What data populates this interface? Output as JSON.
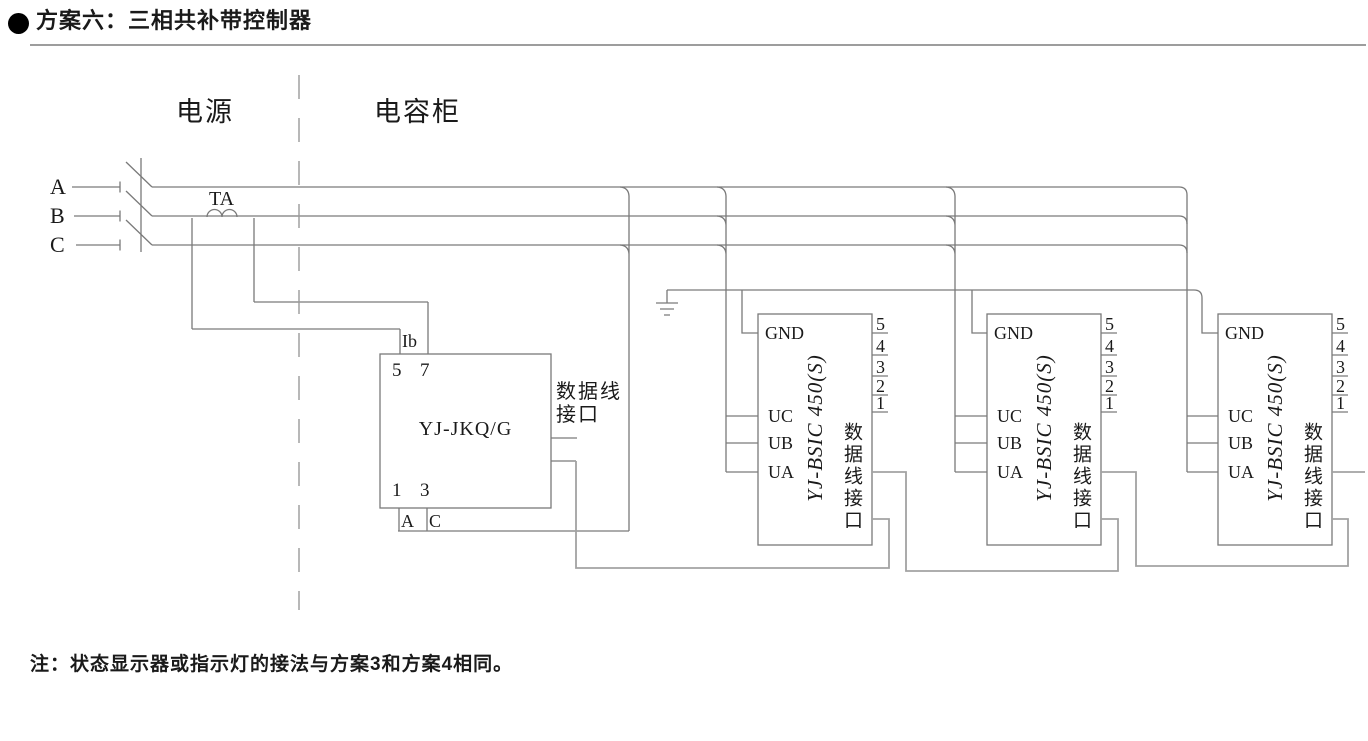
{
  "header": {
    "bullet": "●",
    "title": "方案六：三相共补带控制器"
  },
  "sections": {
    "power": "电源",
    "capacitor_cabinet": "电容柜"
  },
  "phases": [
    "A",
    "B",
    "C"
  ],
  "current_transformer": {
    "label": "TA",
    "secondary_label": "Ib"
  },
  "controller": {
    "name": "YJ-JKQ/G",
    "top_terminals": [
      "5",
      "7"
    ],
    "bottom_terminals": [
      "1",
      "3"
    ],
    "terminal_row": [
      "A",
      "C"
    ],
    "data_port_line1": "数据线",
    "data_port_line2": "接口"
  },
  "modules": {
    "name": "YJ-BSIC 450(S)",
    "left_terminals": [
      "GND",
      "UC",
      "UB",
      "UA"
    ],
    "right_terminals": [
      "5",
      "4",
      "3",
      "2",
      "1"
    ],
    "data_port": "数据线接口",
    "count": 3
  },
  "note": "注：状态显示器或指示灯的接法与方案3和方案4相同。",
  "colors": {
    "wire": "#7a7a7a",
    "bus": "#a2a2a2",
    "dash": "#9a9a9a",
    "text": "#1a1a1a"
  }
}
